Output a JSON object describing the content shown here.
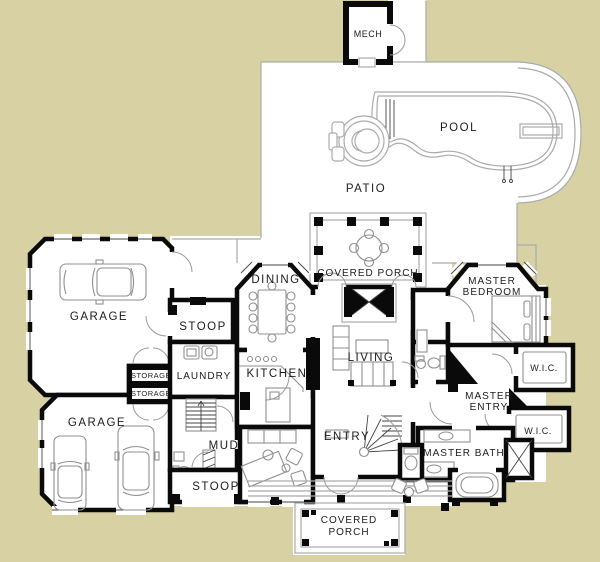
{
  "plan": {
    "title": "House floor plan with pool",
    "colors": {
      "background": "#d8d1a3",
      "wall": "#0a0a0a",
      "outline": "#ababab",
      "furniture": "#8f8f8f"
    },
    "labels": {
      "mech": "MECH",
      "pool": "POOL",
      "patio": "PATIO",
      "covered_porch_top": "COVERED PORCH",
      "dining": "DINING",
      "master_bedroom_1": "MASTER",
      "master_bedroom_2": "BEDROOM",
      "garage_top": "GARAGE",
      "stoop_top": "STOOP",
      "living": "LIVING",
      "wic_top": "W.I.C.",
      "storage_top": "STORAGE",
      "storage_bottom": "STORAGE",
      "laundry": "LAUNDRY",
      "kitchen": "KITCHEN",
      "master_entry_1": "MASTER",
      "master_entry_2": "ENTRY",
      "garage_bottom": "GARAGE",
      "wic_bottom": "W.I.C.",
      "mud": "MUD",
      "entry": "ENTRY",
      "master_bath": "MASTER BATH",
      "stoop_bottom": "STOOP",
      "covered_porch_bottom_1": "COVERED",
      "covered_porch_bottom_2": "PORCH"
    }
  }
}
